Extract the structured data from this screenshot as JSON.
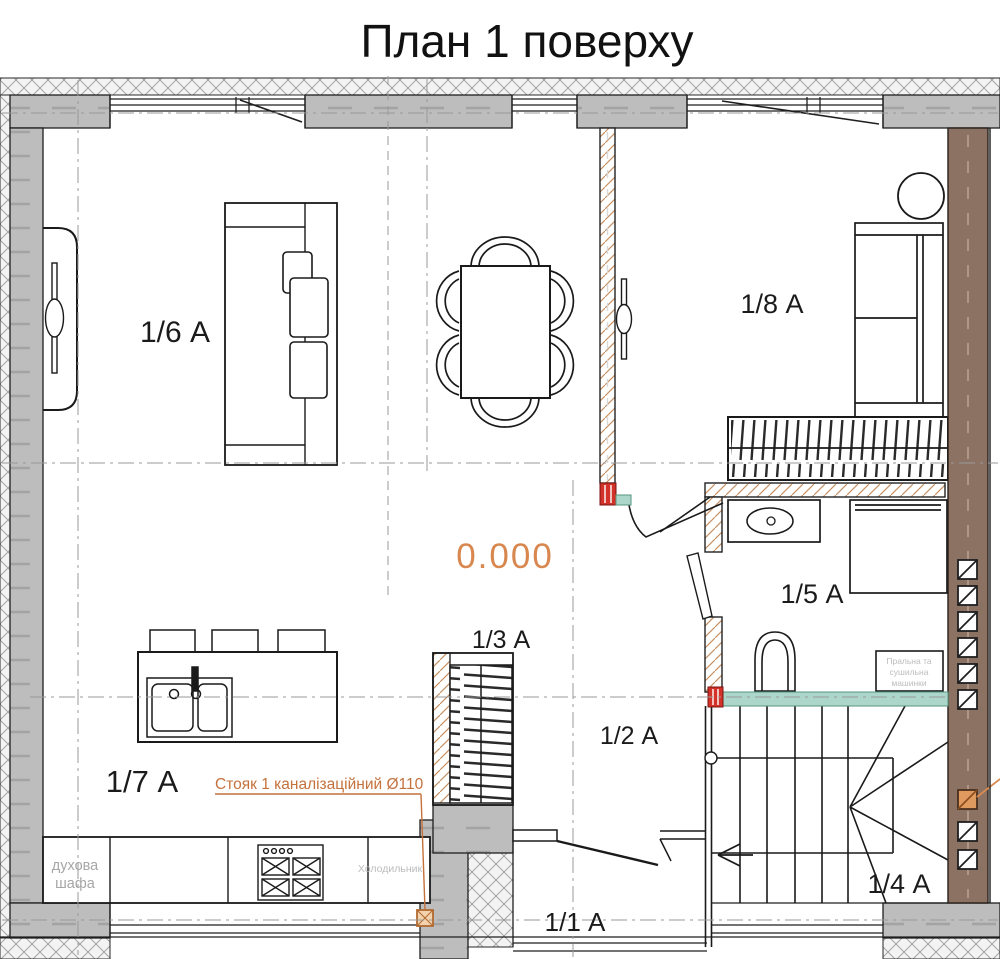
{
  "title": "План 1 поверху",
  "level_mark": "0.000",
  "rooms": [
    {
      "label": "1/6 А"
    },
    {
      "label": "1/7 А"
    },
    {
      "label": "1/8 А"
    },
    {
      "label": "1/5 А"
    },
    {
      "label": "1/4 А"
    },
    {
      "label": "1/3 А"
    },
    {
      "label": "1/2 А"
    },
    {
      "label": "1/1 А"
    }
  ],
  "annotations": {
    "riser_label": "Стояк 1 каналізаційний Ø110",
    "oven_line1": "духова",
    "oven_line2": "шафа",
    "fridge": "Холодильник",
    "washer_line1": "Пральна та",
    "washer_line2": "сушильна",
    "washer_line3": "машинки"
  },
  "colors": {
    "wall_gray": "#bdbdbd",
    "shaft_brown": "#8c7262",
    "plumbing_teal": "#abd6c9",
    "riser_red": "#d3322a",
    "accent_orange": "#d8874e",
    "new_partition_hatch": "#c79064",
    "axis_gray": "#999999"
  }
}
